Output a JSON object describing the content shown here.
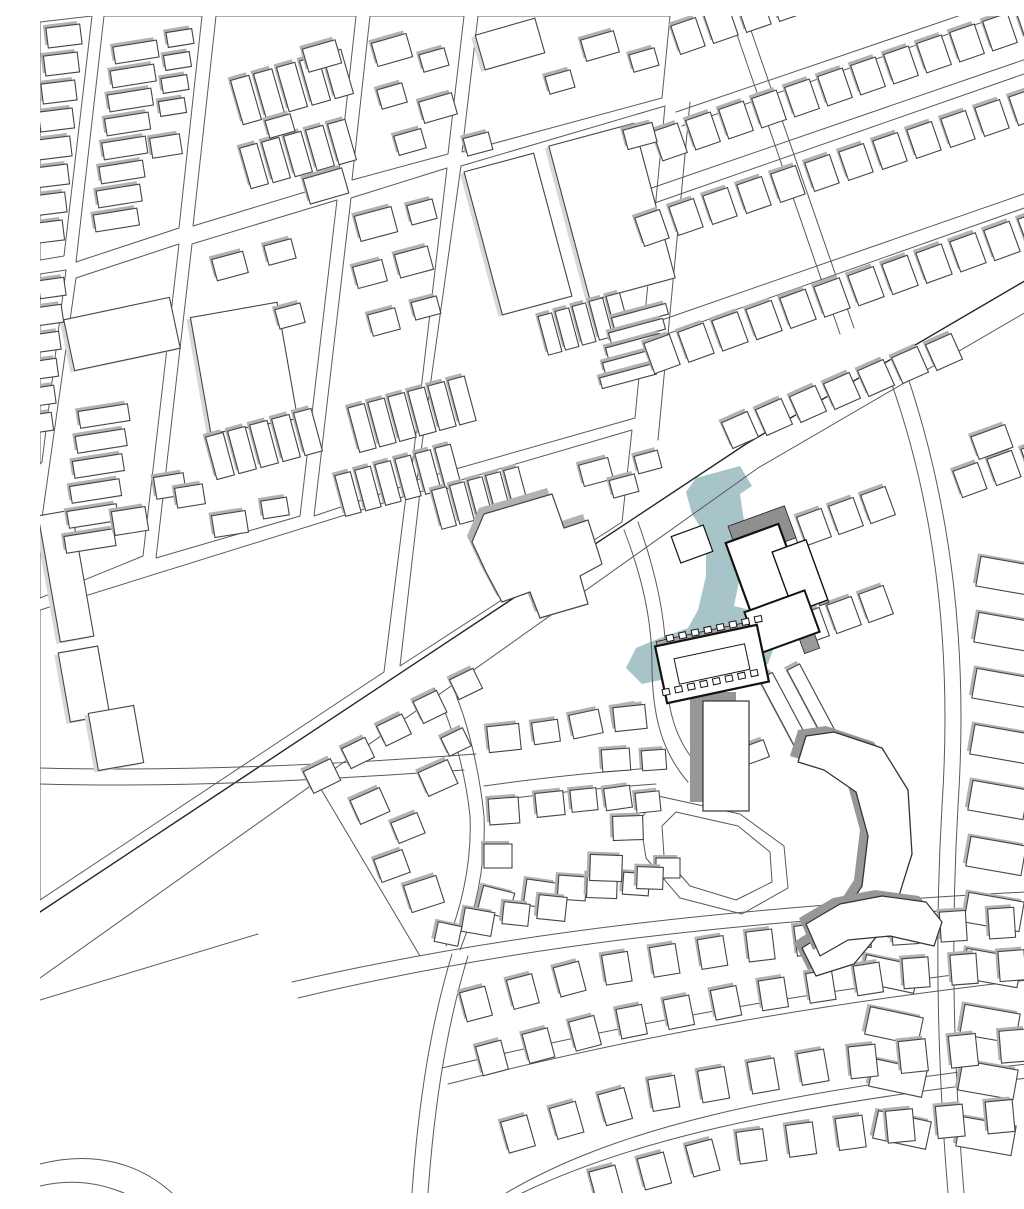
{
  "canvas": {
    "w": 1024,
    "h": 1177
  },
  "colors": {
    "background": "#ffffff",
    "parcel_stroke": "#5a5a5a",
    "street_stroke": "#585858",
    "street_dark": "#262626",
    "building_fill": "#ffffff",
    "building_stroke": "#454545",
    "shadow": "#b2b2b2",
    "shadow_light": "#d8d8d8",
    "shadow_heavy": "#979797",
    "highlight_fill": "#a7c5c8",
    "site_stroke": "#121212"
  },
  "blocks": [
    [
      [
        0,
        6
      ],
      [
        52,
        0
      ],
      [
        24,
        240
      ],
      [
        0,
        244
      ]
    ],
    [
      [
        64,
        0
      ],
      [
        162,
        0
      ],
      [
        139,
        212
      ],
      [
        36,
        246
      ]
    ],
    [
      [
        176,
        0
      ],
      [
        316,
        0
      ],
      [
        298,
        166
      ],
      [
        153,
        210
      ]
    ],
    [
      [
        330,
        0
      ],
      [
        424,
        0
      ],
      [
        408,
        138
      ],
      [
        312,
        164
      ]
    ],
    [
      [
        438,
        0
      ],
      [
        630,
        0
      ],
      [
        622,
        82
      ],
      [
        422,
        136
      ]
    ],
    [
      [
        0,
        258
      ],
      [
        26,
        254
      ],
      [
        2,
        446
      ],
      [
        0,
        448
      ]
    ],
    [
      [
        36,
        262
      ],
      [
        139,
        228
      ],
      [
        103,
        540
      ],
      [
        0,
        582
      ],
      [
        0,
        516
      ]
    ],
    [
      [
        152,
        228
      ],
      [
        297,
        184
      ],
      [
        260,
        500
      ],
      [
        116,
        542
      ]
    ],
    [
      [
        311,
        182
      ],
      [
        407,
        152
      ],
      [
        370,
        468
      ],
      [
        274,
        500
      ]
    ],
    [
      [
        421,
        150
      ],
      [
        625,
        90
      ],
      [
        595,
        402
      ],
      [
        377,
        464
      ]
    ],
    [
      [
        0,
        594
      ],
      [
        366,
        480
      ],
      [
        344,
        656
      ],
      [
        0,
        884
      ]
    ],
    [
      [
        380,
        476
      ],
      [
        592,
        414
      ],
      [
        582,
        506
      ],
      [
        360,
        650
      ]
    ]
  ],
  "streets": [
    {
      "d": "M 1024,242 L 706,428 L 0,896",
      "w": 1.4,
      "k": 1
    },
    {
      "d": "M 1024,274 L 718,452 L 0,962",
      "w": 1,
      "k": 0
    },
    {
      "d": "M 0,984 L 218,918",
      "w": 1,
      "k": 0
    },
    {
      "d": "M 636,96 L 1024,-36",
      "w": 1,
      "k": 0
    },
    {
      "d": "M 642,110 L 1024,-22",
      "w": 1,
      "k": 0
    },
    {
      "d": "M 600,176 L 1024,30",
      "w": 1,
      "k": 0
    },
    {
      "d": "M 606,190 L 1024,44",
      "w": 1,
      "k": 0
    },
    {
      "d": "M 570,322 L 1024,164",
      "w": 1,
      "k": 0
    },
    {
      "d": "M 576,336 L 1024,178",
      "w": 1,
      "k": 0
    },
    {
      "d": "M 692,4 L 800,318",
      "w": 1,
      "k": 0
    },
    {
      "d": "M 706,0 L 814,312",
      "w": 1,
      "k": 0
    },
    {
      "d": "M 650,86 L 618,424",
      "w": 1,
      "k": 0
    },
    {
      "d": "M 846,352 C 898,492 912,640 902,790 C 894,928 898,1056 908,1177",
      "w": 1,
      "k": 0
    },
    {
      "d": "M 862,344 C 914,492 928,640 918,790 C 910,930 914,1058 924,1177",
      "w": 1,
      "k": 0
    },
    {
      "d": "M 584,514 C 602,560 612,606 612,648 C 612,700 622,736 648,766",
      "w": 1,
      "k": 0
    },
    {
      "d": "M 598,506 C 616,556 626,604 626,646 C 626,694 636,726 660,752",
      "w": 1,
      "k": 0
    },
    {
      "d": "M 0,752 C 150,756 300,748 436,738",
      "w": 1,
      "k": 0
    },
    {
      "d": "M 0,768 C 140,772 280,764 424,754",
      "w": 1,
      "k": 0
    },
    {
      "d": "M 408,662 C 428,700 440,760 444,800 C 446,848 436,894 420,934",
      "w": 1,
      "k": 0
    },
    {
      "d": "M 394,672 C 414,710 426,762 430,800 C 432,846 422,890 406,930",
      "w": 1,
      "k": 0
    },
    {
      "d": "M 444,770 C 500,762 560,756 612,752",
      "w": 1,
      "k": 0
    },
    {
      "d": "M 446,786 C 500,778 560,772 616,768",
      "w": 1,
      "k": 0
    },
    {
      "d": "M 272,758 L 380,940",
      "w": 1,
      "k": 0
    },
    {
      "d": "M 252,966 C 470,916 700,890 1024,874",
      "w": 1,
      "k": 0
    },
    {
      "d": "M 258,982 C 474,930 700,904 1024,888",
      "w": 1,
      "k": 0
    },
    {
      "d": "M 402,1052 C 600,1004 800,970 1024,946",
      "w": 1,
      "k": 0
    },
    {
      "d": "M 408,1068 C 604,1018 800,984 1024,960",
      "w": 1,
      "k": 0
    },
    {
      "d": "M 466,1177 C 570,1116 720,1076 1024,1044",
      "w": 1,
      "k": 0
    },
    {
      "d": "M 482,1177 C 580,1130 724,1090 1024,1058",
      "w": 1,
      "k": 0
    },
    {
      "d": "M 412,938 C 390,1010 378,1090 372,1177",
      "w": 1,
      "k": 0
    },
    {
      "d": "M 428,940 C 406,1012 394,1092 388,1177",
      "w": 1,
      "k": 0
    },
    {
      "d": "M 0,1148 C 55,1134 100,1148 132,1177",
      "w": 1,
      "k": 0
    },
    {
      "d": "M 0,1170 C 35,1162 62,1168 84,1177",
      "w": 1,
      "k": 0
    }
  ],
  "loop": {
    "outer": [
      [
        618,
        780
      ],
      [
        700,
        798
      ],
      [
        744,
        830
      ],
      [
        748,
        872
      ],
      [
        702,
        898
      ],
      [
        640,
        882
      ],
      [
        606,
        842
      ],
      [
        600,
        804
      ]
    ],
    "inner": [
      [
        636,
        796
      ],
      [
        698,
        810
      ],
      [
        730,
        836
      ],
      [
        732,
        866
      ],
      [
        696,
        884
      ],
      [
        650,
        870
      ],
      [
        624,
        840
      ],
      [
        622,
        810
      ]
    ]
  },
  "rows": [
    {
      "x": 24,
      "y": 20,
      "dx": -2.5,
      "dy": 28,
      "n": 8,
      "w": 34,
      "h": 20,
      "a": -7
    },
    {
      "x": 96,
      "y": 36,
      "dx": -2.8,
      "dy": 24,
      "n": 8,
      "w": 44,
      "h": 17,
      "a": -9
    },
    {
      "x": 140,
      "y": 22,
      "dx": -2.5,
      "dy": 23,
      "n": 4,
      "w": 26,
      "h": 15,
      "a": -9
    },
    {
      "x": 206,
      "y": 84,
      "dx": 23,
      "dy": -6.5,
      "n": 5,
      "w": 19,
      "h": 46,
      "a": -16
    },
    {
      "x": 214,
      "y": 150,
      "dx": 22,
      "dy": -6,
      "n": 5,
      "w": 18,
      "h": 42,
      "a": -16
    },
    {
      "x": 12,
      "y": 272,
      "dx": -2.5,
      "dy": 27,
      "n": 6,
      "w": 26,
      "h": 18,
      "a": -8
    },
    {
      "x": 64,
      "y": 400,
      "dx": -2.8,
      "dy": 25,
      "n": 6,
      "w": 50,
      "h": 17,
      "a": -9
    },
    {
      "x": 180,
      "y": 440,
      "dx": 22,
      "dy": -6,
      "n": 5,
      "w": 18,
      "h": 44,
      "a": -15
    },
    {
      "x": 322,
      "y": 412,
      "dx": 20,
      "dy": -5.5,
      "n": 6,
      "w": 17,
      "h": 46,
      "a": -15
    },
    {
      "x": 308,
      "y": 478,
      "dx": 20,
      "dy": -5.5,
      "n": 6,
      "w": 16,
      "h": 42,
      "a": -15
    },
    {
      "x": 510,
      "y": 318,
      "dx": 17,
      "dy": -5,
      "n": 5,
      "w": 14,
      "h": 40,
      "a": -15
    },
    {
      "x": 600,
      "y": 300,
      "dx": -3,
      "dy": 15,
      "n": 5,
      "w": 56,
      "h": 11,
      "a": -15
    },
    {
      "x": 404,
      "y": 492,
      "dx": 18,
      "dy": -5,
      "n": 5,
      "w": 15,
      "h": 40,
      "a": -15
    },
    {
      "x": 648,
      "y": 20,
      "dx": 33,
      "dy": -11,
      "n": 12,
      "w": 26,
      "h": 30,
      "a": -19
    },
    {
      "x": 630,
      "y": 126,
      "dx": 33,
      "dy": -11,
      "n": 13,
      "w": 26,
      "h": 31,
      "a": -19
    },
    {
      "x": 612,
      "y": 212,
      "dx": 34,
      "dy": -11,
      "n": 13,
      "w": 26,
      "h": 30,
      "a": -19
    },
    {
      "x": 622,
      "y": 338,
      "dx": 34,
      "dy": -11.3,
      "n": 12,
      "w": 27,
      "h": 32,
      "a": -20
    },
    {
      "x": 700,
      "y": 414,
      "dx": 34,
      "dy": -13,
      "n": 7,
      "w": 28,
      "h": 28,
      "a": -24
    },
    {
      "x": 742,
      "y": 522,
      "dx": 32,
      "dy": -11,
      "n": 4,
      "w": 26,
      "h": 30,
      "a": -20
    },
    {
      "x": 772,
      "y": 610,
      "dx": 32,
      "dy": -11,
      "n": 3,
      "w": 26,
      "h": 30,
      "a": -20
    },
    {
      "x": 966,
      "y": 560,
      "dx": -2,
      "dy": 56,
      "n": 11,
      "w": 56,
      "h": 30,
      "a": 10
    },
    {
      "x": 846,
      "y": 906,
      "dx": 4,
      "dy": 52,
      "n": 5,
      "w": 54,
      "h": 28,
      "a": 12
    }
  ],
  "singles": [
    [
      126,
      130,
      30,
      20,
      -9
    ],
    [
      282,
      40,
      34,
      24,
      -16
    ],
    [
      286,
      170,
      40,
      26,
      -16
    ],
    [
      240,
      110,
      26,
      18,
      -16
    ],
    [
      352,
      34,
      36,
      24,
      -16
    ],
    [
      394,
      44,
      26,
      18,
      -16
    ],
    [
      352,
      80,
      26,
      20,
      -16
    ],
    [
      398,
      92,
      34,
      22,
      -16
    ],
    [
      370,
      126,
      28,
      20,
      -16
    ],
    [
      560,
      30,
      34,
      22,
      -16
    ],
    [
      604,
      44,
      26,
      18,
      -16
    ],
    [
      520,
      66,
      26,
      18,
      -16
    ],
    [
      190,
      250,
      32,
      22,
      -15
    ],
    [
      240,
      236,
      28,
      20,
      -15
    ],
    [
      250,
      300,
      26,
      20,
      -15
    ],
    [
      130,
      470,
      30,
      22,
      -9
    ],
    [
      90,
      505,
      34,
      24,
      -9
    ],
    [
      150,
      480,
      28,
      20,
      -9
    ],
    [
      190,
      508,
      34,
      22,
      -9
    ],
    [
      235,
      492,
      26,
      18,
      -9
    ],
    [
      336,
      208,
      38,
      26,
      -15
    ],
    [
      382,
      196,
      26,
      20,
      -15
    ],
    [
      330,
      258,
      30,
      22,
      -15
    ],
    [
      374,
      246,
      34,
      24,
      -15
    ],
    [
      344,
      306,
      28,
      22,
      -15
    ],
    [
      386,
      292,
      26,
      18,
      -15
    ],
    [
      438,
      128,
      26,
      18,
      -15
    ],
    [
      600,
      120,
      30,
      20,
      -15
    ],
    [
      556,
      456,
      30,
      22,
      -15
    ],
    [
      584,
      470,
      26,
      18,
      -15
    ],
    [
      608,
      446,
      24,
      18,
      -15
    ],
    [
      930,
      464,
      26,
      28,
      -20
    ],
    [
      964,
      452,
      26,
      28,
      -20
    ],
    [
      998,
      442,
      26,
      28,
      -20
    ],
    [
      952,
      426,
      36,
      24,
      -20
    ],
    [
      282,
      760,
      30,
      24,
      -26
    ],
    [
      318,
      737,
      26,
      22,
      -26
    ],
    [
      354,
      714,
      28,
      22,
      -26
    ],
    [
      390,
      691,
      26,
      24,
      -26
    ],
    [
      426,
      668,
      26,
      22,
      -26
    ],
    [
      330,
      790,
      32,
      26,
      -24
    ],
    [
      368,
      812,
      28,
      22,
      -22
    ],
    [
      352,
      850,
      30,
      24,
      -20
    ],
    [
      384,
      878,
      34,
      28,
      -18
    ],
    [
      398,
      762,
      32,
      26,
      -24
    ],
    [
      416,
      726,
      24,
      20,
      -26
    ],
    [
      464,
      722,
      32,
      26,
      -6
    ],
    [
      506,
      716,
      26,
      22,
      -8
    ],
    [
      546,
      708,
      30,
      24,
      -12
    ],
    [
      586,
      700,
      26,
      20,
      -10
    ],
    [
      464,
      795,
      30,
      26,
      -4
    ],
    [
      510,
      788,
      28,
      24,
      -6
    ],
    [
      544,
      784,
      26,
      22,
      -6
    ],
    [
      578,
      782,
      26,
      22,
      -8
    ],
    [
      608,
      786,
      24,
      20,
      -6
    ],
    [
      458,
      840,
      28,
      24,
      0
    ],
    [
      500,
      878,
      30,
      26,
      8
    ],
    [
      532,
      872,
      28,
      24,
      4
    ],
    [
      562,
      870,
      30,
      24,
      2
    ],
    [
      596,
      868,
      26,
      22,
      4
    ],
    [
      628,
      852,
      24,
      20,
      0
    ],
    [
      456,
      886,
      32,
      26,
      14
    ],
    [
      590,
      702,
      32,
      24,
      -6
    ],
    [
      576,
      744,
      28,
      22,
      -4
    ],
    [
      614,
      744,
      24,
      20,
      -4
    ],
    [
      588,
      812,
      30,
      24,
      -2
    ],
    [
      566,
      852,
      32,
      26,
      2
    ],
    [
      610,
      862,
      26,
      22,
      2
    ],
    [
      748,
      702,
      15,
      95,
      -28
    ],
    [
      774,
      690,
      14,
      88,
      -28
    ],
    [
      716,
      736,
      22,
      18,
      -20
    ],
    [
      438,
      906,
      30,
      24,
      10
    ],
    [
      476,
      898,
      26,
      22,
      6
    ],
    [
      512,
      892,
      28,
      24,
      6
    ],
    [
      408,
      918,
      24,
      20,
      12
    ]
  ],
  "lights": [
    [
      82,
      318,
      108,
      52,
      -12
    ],
    [
      204,
      352,
      88,
      118,
      -10
    ],
    [
      478,
      218,
      72,
      148,
      -15
    ],
    [
      572,
      196,
      88,
      160,
      -15
    ],
    [
      470,
      28,
      62,
      36,
      -16
    ],
    [
      26,
      560,
      34,
      128,
      -10
    ],
    [
      44,
      668,
      40,
      70,
      -10
    ],
    [
      76,
      722,
      46,
      58,
      -10
    ]
  ],
  "school_pts": [
    [
      444,
      498
    ],
    [
      512,
      478
    ],
    [
      524,
      512
    ],
    [
      548,
      504
    ],
    [
      562,
      548
    ],
    [
      540,
      560
    ],
    [
      548,
      588
    ],
    [
      500,
      602
    ],
    [
      490,
      576
    ],
    [
      462,
      586
    ],
    [
      446,
      556
    ],
    [
      432,
      526
    ]
  ],
  "arc_rows": [
    {
      "pts": [
        [
          436,
          988
        ],
        [
          560,
          955
        ],
        [
          700,
          932
        ],
        [
          840,
          915
        ],
        [
          1010,
          904
        ]
      ],
      "n": 13,
      "w": 26,
      "h": 30
    },
    {
      "pts": [
        [
          452,
          1042
        ],
        [
          580,
          1008
        ],
        [
          720,
          980
        ],
        [
          860,
          958
        ],
        [
          1020,
          946
        ]
      ],
      "n": 13,
      "w": 26,
      "h": 30
    },
    {
      "pts": [
        [
          478,
          1118
        ],
        [
          620,
          1078
        ],
        [
          780,
          1050
        ],
        [
          950,
          1032
        ],
        [
          1024,
          1026
        ]
      ],
      "n": 12,
      "w": 27,
      "h": 32
    },
    {
      "pts": [
        [
          566,
          1168
        ],
        [
          700,
          1132
        ],
        [
          860,
          1110
        ],
        [
          1010,
          1096
        ]
      ],
      "n": 10,
      "w": 27,
      "h": 32
    }
  ],
  "tower": {
    "x": 686,
    "y": 740,
    "w": 46,
    "h": 110,
    "sdx": -13,
    "sdy": -9
  },
  "horseshoe": [
    [
      794,
      716
    ],
    [
      842,
      732
    ],
    [
      868,
      774
    ],
    [
      872,
      838
    ],
    [
      852,
      902
    ],
    [
      814,
      948
    ],
    [
      776,
      960
    ],
    [
      762,
      932
    ],
    [
      796,
      910
    ],
    [
      822,
      870
    ],
    [
      828,
      820
    ],
    [
      816,
      776
    ],
    [
      784,
      754
    ],
    [
      758,
      746
    ],
    [
      766,
      720
    ]
  ],
  "curved_slab": [
    [
      766,
      908
    ],
    [
      800,
      888
    ],
    [
      842,
      880
    ],
    [
      886,
      886
    ],
    [
      902,
      906
    ],
    [
      894,
      930
    ],
    [
      850,
      920
    ],
    [
      808,
      924
    ],
    [
      780,
      940
    ]
  ],
  "site": {
    "highlight": [
      [
        656,
        462
      ],
      [
        700,
        450
      ],
      [
        712,
        470
      ],
      [
        700,
        478
      ],
      [
        706,
        518
      ],
      [
        700,
        560
      ],
      [
        694,
        590
      ],
      [
        726,
        598
      ],
      [
        738,
        620
      ],
      [
        728,
        648
      ],
      [
        692,
        652
      ],
      [
        660,
        656
      ],
      [
        630,
        662
      ],
      [
        602,
        668
      ],
      [
        586,
        652
      ],
      [
        596,
        632
      ],
      [
        620,
        622
      ],
      [
        648,
        612
      ],
      [
        658,
        594
      ],
      [
        666,
        560
      ],
      [
        666,
        520
      ],
      [
        652,
        498
      ],
      [
        646,
        476
      ]
    ],
    "gray_rects": [
      [
        722,
        516,
        60,
        34,
        -20,
        "#8f8f8f"
      ],
      [
        774,
        560,
        10,
        60,
        -20,
        "#ababab"
      ],
      [
        766,
        618,
        16,
        36,
        -20,
        "#9a9a9a"
      ],
      [
        666,
        620,
        100,
        10,
        -12,
        "#a9a9a9"
      ]
    ],
    "white_rects": [
      [
        726,
        556,
        56,
        82,
        -20,
        2.2
      ],
      [
        760,
        560,
        36,
        64,
        -20,
        1.4
      ],
      [
        742,
        606,
        64,
        44,
        -20,
        2
      ],
      [
        672,
        648,
        104,
        58,
        -12,
        2.2
      ],
      [
        672,
        648,
        72,
        26,
        -12,
        1
      ],
      [
        652,
        528,
        34,
        28,
        -20,
        1.2
      ]
    ],
    "teeth": [
      {
        "x": 630,
        "y": 622,
        "dx": 12.6,
        "dy": -2.7,
        "n": 8,
        "w": 7,
        "h": 6,
        "a": -12
      },
      {
        "x": 626,
        "y": 676,
        "dx": 12.6,
        "dy": -2.7,
        "n": 8,
        "w": 7,
        "h": 6,
        "a": -12
      }
    ]
  }
}
